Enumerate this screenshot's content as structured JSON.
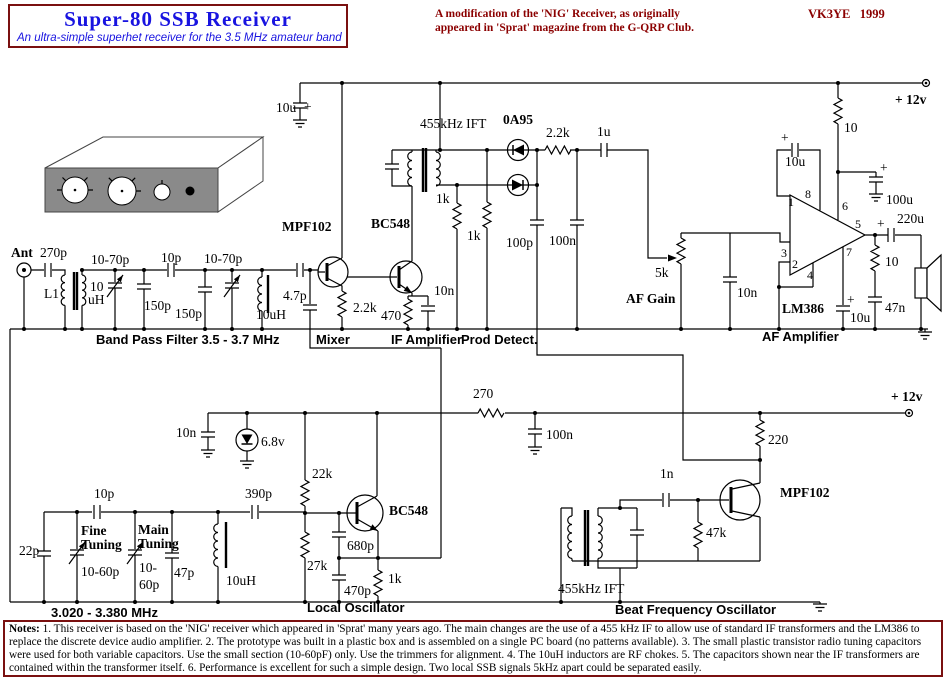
{
  "header": {
    "title": "Super-80 SSB Receiver",
    "subtitle": "An ultra-simple superhet receiver for the 3.5 MHz amateur band",
    "note_line1": "A modification of the 'NIG' Receiver, as originally",
    "note_line2": "appeared in 'Sprat' magazine from the G-QRP Club.",
    "callsign": "VK3YE   1999"
  },
  "schematic": {
    "supply_color": "#000000",
    "labels": [
      {
        "name": "cap-10u-supply-label",
        "text": "10u",
        "x": 276,
        "y": 112,
        "cls": "v"
      },
      {
        "name": "plus-10u-supply",
        "text": "+",
        "x": 304,
        "y": 111,
        "cls": "v"
      },
      {
        "name": "ift1-label",
        "text": "455kHz IFT",
        "x": 420,
        "y": 128,
        "cls": "v"
      },
      {
        "name": "diode-0a95-label",
        "text": "0A95",
        "x": 503,
        "y": 124,
        "cls": "b"
      },
      {
        "name": "res-2k2-det-label",
        "text": "2.2k",
        "x": 546,
        "y": 137,
        "cls": "v"
      },
      {
        "name": "cap-1u-label",
        "text": "1u",
        "x": 597,
        "y": 136,
        "cls": "v"
      },
      {
        "name": "supply-top-label",
        "text": "+ 12v",
        "x": 895,
        "y": 104,
        "cls": "b"
      },
      {
        "name": "res-10-supply-label",
        "text": "10",
        "x": 844,
        "y": 132,
        "cls": "v"
      },
      {
        "name": "plus-c18",
        "text": "+",
        "x": 781,
        "y": 142,
        "cls": "v"
      },
      {
        "name": "cap-10u-18-label",
        "text": "10u",
        "x": 785,
        "y": 166,
        "cls": "v"
      },
      {
        "name": "pin-1",
        "text": "1",
        "x": 788,
        "y": 206,
        "cls": "p"
      },
      {
        "name": "pin-8",
        "text": "8",
        "x": 805,
        "y": 198,
        "cls": "p"
      },
      {
        "name": "pin-3",
        "text": "3",
        "x": 781,
        "y": 257,
        "cls": "p"
      },
      {
        "name": "pin-2",
        "text": "2",
        "x": 792,
        "y": 268,
        "cls": "p"
      },
      {
        "name": "pin-4",
        "text": "4",
        "x": 807,
        "y": 279,
        "cls": "p"
      },
      {
        "name": "pin-6",
        "text": "6",
        "x": 842,
        "y": 210,
        "cls": "p"
      },
      {
        "name": "pin-5",
        "text": "5",
        "x": 855,
        "y": 228,
        "cls": "p"
      },
      {
        "name": "pin-7",
        "text": "7",
        "x": 846,
        "y": 256,
        "cls": "p"
      },
      {
        "name": "plus-100u",
        "text": "+",
        "x": 880,
        "y": 172,
        "cls": "v"
      },
      {
        "name": "cap-100u-label",
        "text": "100u",
        "x": 886,
        "y": 204,
        "cls": "v"
      },
      {
        "name": "plus-220u",
        "text": "+",
        "x": 877,
        "y": 228,
        "cls": "v"
      },
      {
        "name": "cap-220u-label",
        "text": "220u",
        "x": 897,
        "y": 223,
        "cls": "v"
      },
      {
        "name": "res-10-zobel-label",
        "text": "10",
        "x": 885,
        "y": 266,
        "cls": "v"
      },
      {
        "name": "cap-47n-label",
        "text": "47n",
        "x": 885,
        "y": 312,
        "cls": "v"
      },
      {
        "name": "plus-10u-pin7",
        "text": "+",
        "x": 847,
        "y": 304,
        "cls": "v"
      },
      {
        "name": "cap-10u-pin7-label",
        "text": "10u",
        "x": 850,
        "y": 322,
        "cls": "v"
      },
      {
        "name": "ic-lm386-label",
        "text": "LM386",
        "x": 782,
        "y": 313,
        "cls": "b"
      },
      {
        "name": "ant-label",
        "text": "Ant",
        "x": 11,
        "y": 257,
        "cls": "b"
      },
      {
        "name": "cap-270p-label",
        "text": "270p",
        "x": 40,
        "y": 257,
        "cls": "v"
      },
      {
        "name": "l1-label",
        "text": "L1",
        "x": 44,
        "y": 298,
        "cls": "v"
      },
      {
        "name": "l1-10-label",
        "text": "10",
        "x": 90,
        "y": 291,
        "cls": "v"
      },
      {
        "name": "l1-uh-label",
        "text": "uH",
        "x": 88,
        "y": 304,
        "cls": "v"
      },
      {
        "name": "trim1-label",
        "text": "10-70p",
        "x": 91,
        "y": 264,
        "cls": "v"
      },
      {
        "name": "cap-150p-1-label",
        "text": "150p",
        "x": 144,
        "y": 310,
        "cls": "v"
      },
      {
        "name": "cap-10p-bpf-label",
        "text": "10p",
        "x": 161,
        "y": 262,
        "cls": "v"
      },
      {
        "name": "cap-150p-2-label",
        "text": "150p",
        "x": 175,
        "y": 318,
        "cls": "v"
      },
      {
        "name": "trim2-label",
        "text": "10-70p",
        "x": 204,
        "y": 263,
        "cls": "v"
      },
      {
        "name": "choke-10uh-bpf-label",
        "text": "10uH",
        "x": 256,
        "y": 319,
        "cls": "v"
      },
      {
        "name": "cap-4p7-label",
        "text": "4.7p",
        "x": 283,
        "y": 300,
        "cls": "v"
      },
      {
        "name": "mixer-mpf102-label",
        "text": "MPF102",
        "x": 282,
        "y": 231,
        "cls": "b"
      },
      {
        "name": "res-2k2-mixer-label",
        "text": "2.2k",
        "x": 353,
        "y": 312,
        "cls": "v"
      },
      {
        "name": "ifamp-bc548-label",
        "text": "BC548",
        "x": 371,
        "y": 228,
        "cls": "b"
      },
      {
        "name": "res-470-label",
        "text": "470",
        "x": 381,
        "y": 320,
        "cls": "v"
      },
      {
        "name": "cap-10n-if-label",
        "text": "10n",
        "x": 434,
        "y": 295,
        "cls": "v"
      },
      {
        "name": "res-1k-a-label",
        "text": "1k",
        "x": 436,
        "y": 203,
        "cls": "v"
      },
      {
        "name": "res-1k-b-label",
        "text": "1k",
        "x": 467,
        "y": 240,
        "cls": "v"
      },
      {
        "name": "cap-100p-label",
        "text": "100p",
        "x": 506,
        "y": 247,
        "cls": "v"
      },
      {
        "name": "cap-100n-det-label",
        "text": "100n",
        "x": 549,
        "y": 245,
        "cls": "v"
      },
      {
        "name": "pot-5k-label",
        "text": "5k",
        "x": 655,
        "y": 277,
        "cls": "v"
      },
      {
        "name": "af-gain-label",
        "text": "AF Gain",
        "x": 626,
        "y": 303,
        "cls": "b"
      },
      {
        "name": "cap-10n-af-label",
        "text": "10n",
        "x": 737,
        "y": 297,
        "cls": "v"
      },
      {
        "name": "section-bpf",
        "text": "Band Pass Filter 3.5 - 3.7 MHz",
        "x": 96,
        "y": 344,
        "cls": "s"
      },
      {
        "name": "section-mixer",
        "text": "Mixer",
        "x": 316,
        "y": 344,
        "cls": "s"
      },
      {
        "name": "section-ifamp",
        "text": "IF Amplifier",
        "x": 391,
        "y": 344,
        "cls": "s"
      },
      {
        "name": "section-proddet",
        "text": "Prod Detect.",
        "x": 461,
        "y": 344,
        "cls": "s"
      },
      {
        "name": "section-afamp",
        "text": "AF Amplifier",
        "x": 762,
        "y": 341,
        "cls": "s"
      },
      {
        "name": "supply-bottom-label",
        "text": "+ 12v",
        "x": 891,
        "y": 401,
        "cls": "b"
      },
      {
        "name": "res-270-label",
        "text": "270",
        "x": 473,
        "y": 398,
        "cls": "v"
      },
      {
        "name": "cap-10n-lo-label",
        "text": "10n",
        "x": 176,
        "y": 437,
        "cls": "v"
      },
      {
        "name": "zener-6v8-label",
        "text": "6.8v",
        "x": 261,
        "y": 446,
        "cls": "v"
      },
      {
        "name": "res-22k-label",
        "text": "22k",
        "x": 312,
        "y": 478,
        "cls": "v"
      },
      {
        "name": "cap-100n-bot-label",
        "text": "100n",
        "x": 546,
        "y": 439,
        "cls": "v"
      },
      {
        "name": "res-220-label",
        "text": "220",
        "x": 768,
        "y": 444,
        "cls": "v"
      },
      {
        "name": "bfo-mpf102-label",
        "text": "MPF102",
        "x": 780,
        "y": 497,
        "cls": "b"
      },
      {
        "name": "cap-1n-label",
        "text": "1n",
        "x": 660,
        "y": 478,
        "cls": "v"
      },
      {
        "name": "res-47k-label",
        "text": "47k",
        "x": 706,
        "y": 537,
        "cls": "v"
      },
      {
        "name": "cap-22p-label",
        "text": "22p",
        "x": 19,
        "y": 555,
        "cls": "v"
      },
      {
        "name": "cap-10p-lo-label",
        "text": "10p",
        "x": 94,
        "y": 498,
        "cls": "v"
      },
      {
        "name": "fine-label-1",
        "text": "Fine",
        "x": 81,
        "y": 535,
        "cls": "b"
      },
      {
        "name": "fine-label-2",
        "text": "Tuning",
        "x": 81,
        "y": 549,
        "cls": "b"
      },
      {
        "name": "fine-label-3",
        "text": "10-60p",
        "x": 81,
        "y": 576,
        "cls": "v"
      },
      {
        "name": "main-label-1",
        "text": "Main",
        "x": 138,
        "y": 534,
        "cls": "b"
      },
      {
        "name": "main-label-2",
        "text": "Tuning",
        "x": 138,
        "y": 548,
        "cls": "b"
      },
      {
        "name": "main-label-3",
        "text": "10-",
        "x": 139,
        "y": 572,
        "cls": "v"
      },
      {
        "name": "main-label-4",
        "text": "60p",
        "x": 139,
        "y": 589,
        "cls": "v"
      },
      {
        "name": "cap-47p-label",
        "text": "47p",
        "x": 174,
        "y": 577,
        "cls": "v"
      },
      {
        "name": "choke-10uh-lo-label",
        "text": "10uH",
        "x": 226,
        "y": 585,
        "cls": "v"
      },
      {
        "name": "cap-390p-label",
        "text": "390p",
        "x": 245,
        "y": 498,
        "cls": "v"
      },
      {
        "name": "lo-bc548-label",
        "text": "BC548",
        "x": 389,
        "y": 515,
        "cls": "b"
      },
      {
        "name": "cap-680p-label",
        "text": "680p",
        "x": 347,
        "y": 550,
        "cls": "v"
      },
      {
        "name": "res-27k-label",
        "text": "27k",
        "x": 307,
        "y": 570,
        "cls": "v"
      },
      {
        "name": "cap-470p-label",
        "text": "470p",
        "x": 344,
        "y": 595,
        "cls": "v"
      },
      {
        "name": "res-1k-lo-label",
        "text": "1k",
        "x": 388,
        "y": 583,
        "cls": "v"
      },
      {
        "name": "ift2-label",
        "text": "455kHz IFT",
        "x": 558,
        "y": 593,
        "cls": "v"
      },
      {
        "name": "section-lo-range",
        "text": "3.020 - 3.380 MHz",
        "x": 51,
        "y": 617,
        "cls": "s"
      },
      {
        "name": "section-lo",
        "text": "Local Oscillator",
        "x": 307,
        "y": 612,
        "cls": "s"
      },
      {
        "name": "section-bfo",
        "text": "Beat Frequency Oscillator",
        "x": 615,
        "y": 614,
        "cls": "s"
      }
    ]
  },
  "notes": {
    "heading": "Notes:",
    "body": "1. This receiver is based on the 'NIG' receiver which appeared in 'Sprat' many years ago.  The main changes are the use of a 455 kHz IF to allow use of standard IF transformers and the LM386 to replace the discrete device audio amplifier.  2. The prototype was built in a plastic box and is assembled on a single PC board (no patterns available). 3.  The small plastic transistor radio tuning capacitors were used for both variable capacitors.  Use the small section (10-60pF) only.  Use the trimmers for alignment.  4. The 10uH inductors are  RF chokes.  5. The capacitors shown near the IF transformers are contained within the transformer itself. 6. Performance is excellent for such a simple design. Two local SSB signals 5kHz apart could be separated easily."
  }
}
